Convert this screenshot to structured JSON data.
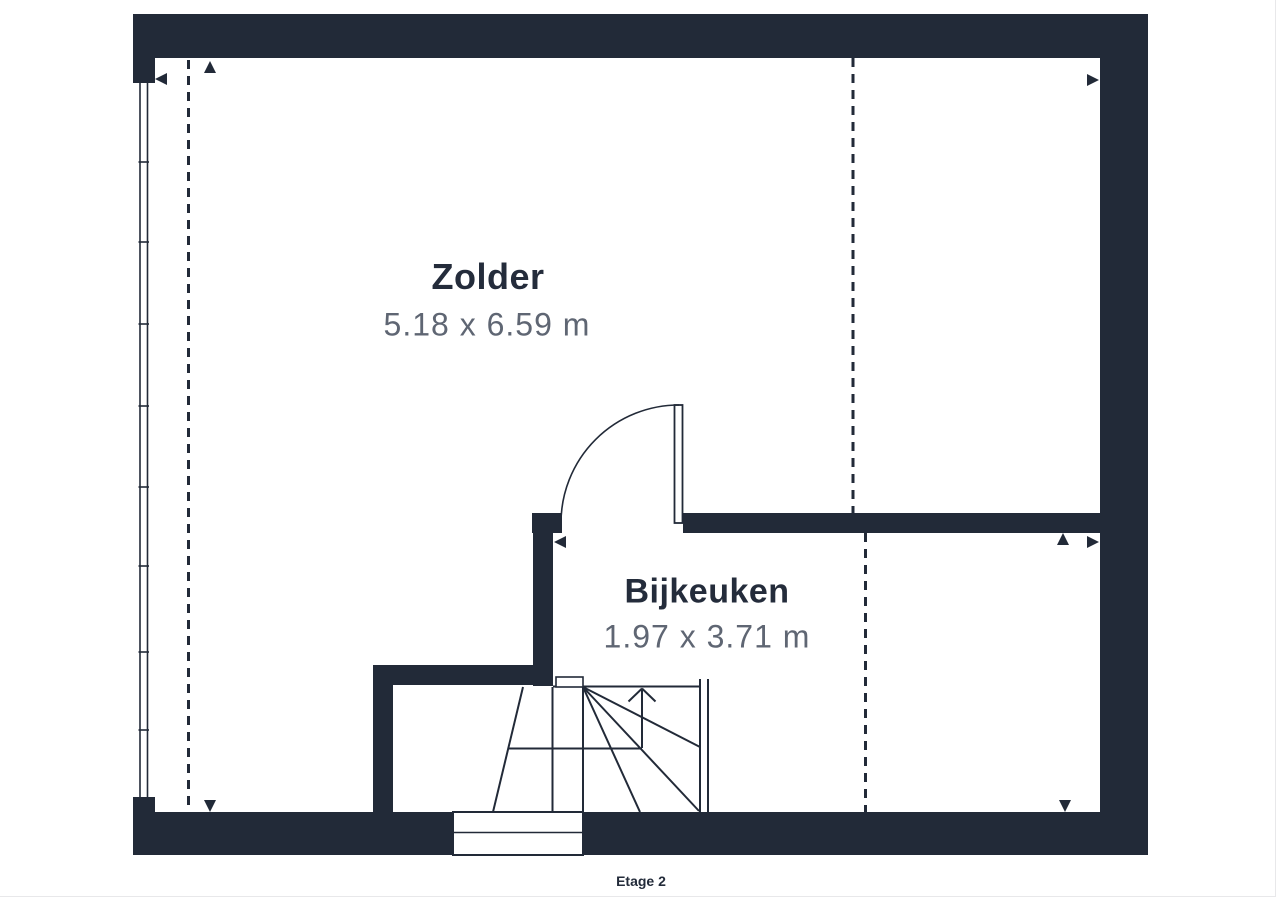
{
  "floorplan": {
    "floor_label": "Etage 2",
    "rooms": [
      {
        "name": "Zolder",
        "dimensions": "5.18 x 6.59 m"
      },
      {
        "name": "Bijkeuken",
        "dimensions": "1.97 x 3.71 m"
      }
    ],
    "colors": {
      "wall": "#222a38",
      "room_name_text": "#242c3b",
      "dimension_text": "#5f6673",
      "background": "#ffffff",
      "page_border": "#e8e8ea"
    },
    "icons": [
      "dimension-arrow-left-icon",
      "dimension-arrow-right-icon",
      "dimension-arrow-up-icon",
      "dimension-arrow-down-icon",
      "stairs-direction-arrow-icon"
    ]
  }
}
